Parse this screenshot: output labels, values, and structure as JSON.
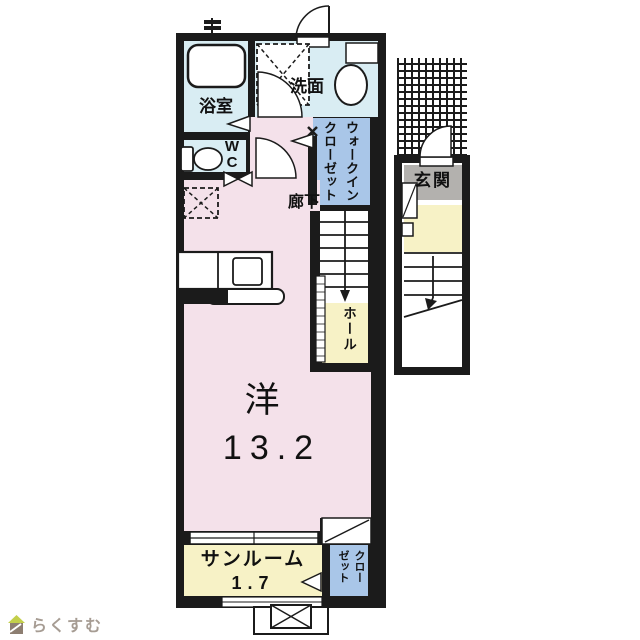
{
  "colors": {
    "wall": "#1b1b1b",
    "room-pink": "#f4e1ea",
    "wet-blue": "#d9edf3",
    "closet-blue": "#a9c6e8",
    "hall-yellow": "#f7f2c6",
    "label-gray": "#b3b1ae",
    "logo-green": "#c3cf4b",
    "logo-brown": "#8d7e71",
    "logo-text": "#a69c93"
  },
  "plan": {
    "rooms": {
      "bathroom": {
        "label": "浴室"
      },
      "washroom": {
        "label": "洗面"
      },
      "wc": {
        "label": "W\nC"
      },
      "hallway": {
        "label": "廊下"
      },
      "walk_in_closet": {
        "label": "ウォークインクローゼット"
      },
      "hall": {
        "label": "ホール"
      },
      "main_room": {
        "label": "洋",
        "area": "13.2"
      },
      "sunroom": {
        "label": "サンルーム",
        "area": "1.7"
      },
      "closet": {
        "label": "クローゼット"
      },
      "entrance": {
        "label": "玄関"
      }
    }
  },
  "logo": {
    "text": "らくすむ"
  }
}
